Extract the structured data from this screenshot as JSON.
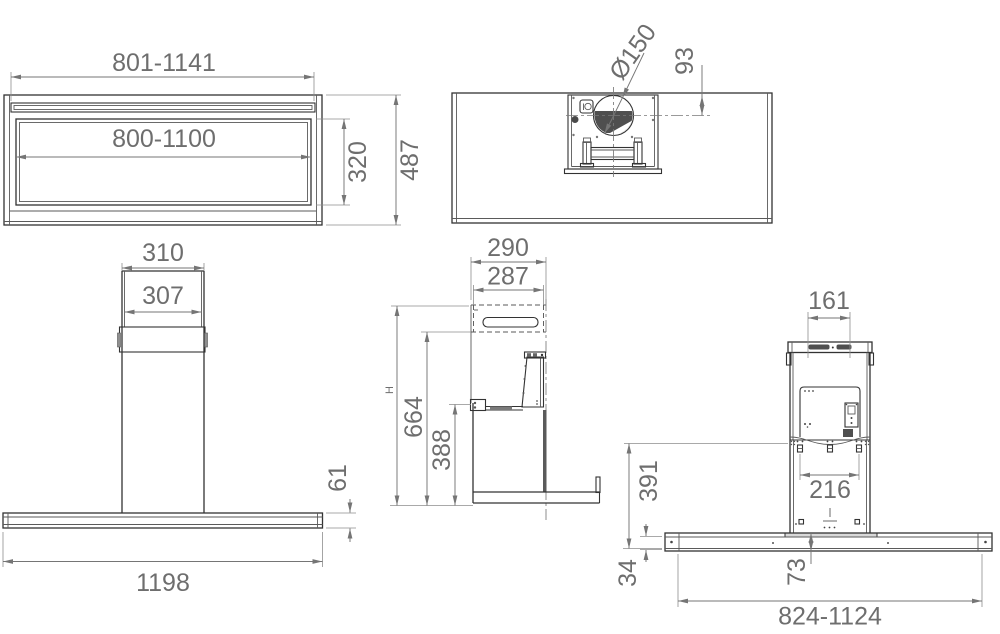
{
  "document": {
    "type": "technical-drawing",
    "subject": "island cooker hood dimensional drawing",
    "background_color": "#ffffff",
    "object_line_color": "#333333",
    "dimension_color": "#757575",
    "text_color": "#6e6e6e"
  },
  "views": {
    "canopy_plan": {
      "width_max": "801-1141",
      "cutout_width": "800-1100",
      "cutout_depth": "320",
      "total_depth": "487"
    },
    "ceiling_top": {
      "duct_diameter": "Ø150",
      "duct_offset": "93"
    },
    "front": {
      "chimney_width_outer": "310",
      "chimney_width_inner": "307",
      "canopy_thickness": "61",
      "canopy_width": "1198"
    },
    "side": {
      "depth_outer": "290",
      "depth_inner": "287",
      "total_height": "H",
      "height_to_handle": "664",
      "height_body": "388"
    },
    "rear": {
      "cap_slot_width": "161",
      "mount_hole_spacing": "216",
      "panel_height": "391",
      "canopy_profile_height": "34",
      "center_drop": "73",
      "glass_width_range": "824-1124"
    }
  }
}
